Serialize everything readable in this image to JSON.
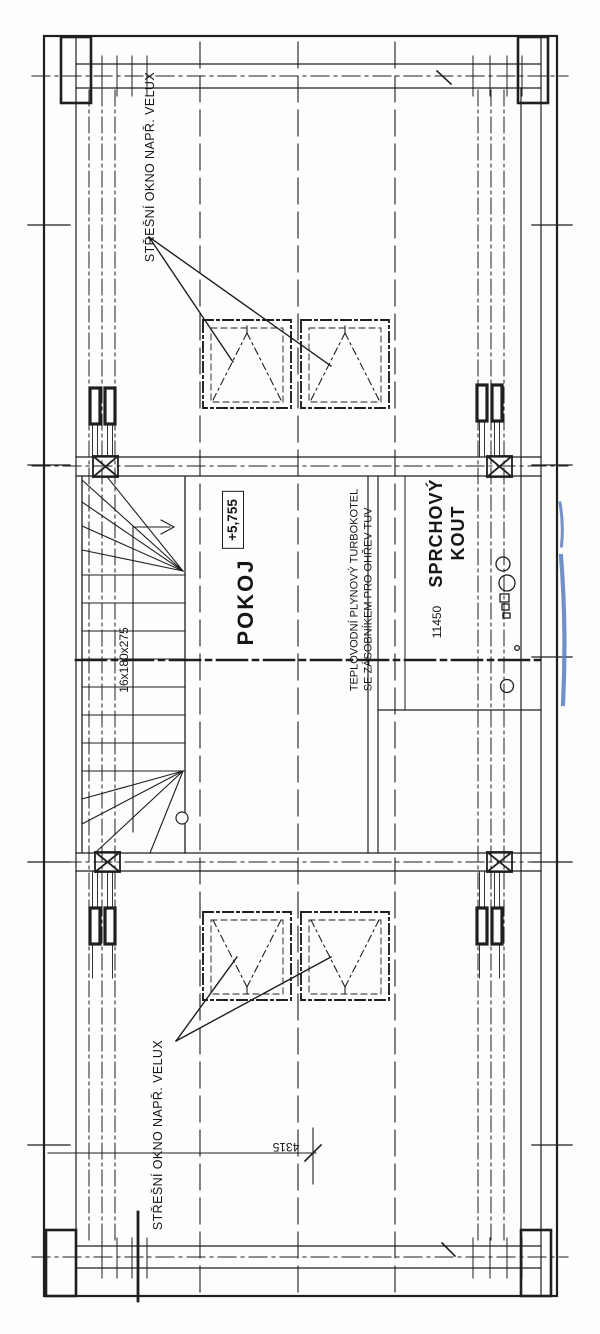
{
  "document": {
    "kind": "scanned architectural floor plan (attic level)",
    "language": "Czech"
  },
  "colors": {
    "ink": "#1f1f1f",
    "paper": "#fdfdfb",
    "pen_mark_blue": "#5b7ec0"
  },
  "labels": {
    "roof_window_top": "STŘEŠNÍ OKNO NAPŘ. VELUX",
    "roof_window_bottom": "STŘEŠNÍ OKNO NAPŘ. VELUX",
    "room": "POKOJ",
    "elevation": "+5,755",
    "shower_line1": "SPRCHOVÝ",
    "shower_line2": "KOUT",
    "boiler_line1": "TEPLOVODNÍ PLYNOVÝ TURBOKOTEL",
    "boiler_line2": "SE ZÁSOBNÍKEM PRO OHŘEV TUV",
    "stair_dimension": "16x180x275",
    "dim_room_width": "11450",
    "dim_bottom": "4315"
  }
}
